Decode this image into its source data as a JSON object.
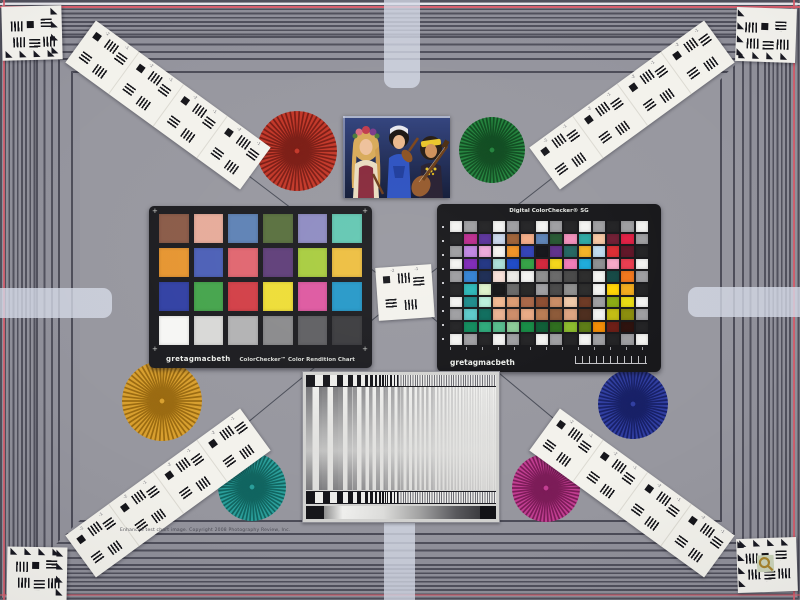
{
  "scene": {
    "type": "camera test chart scene photograph",
    "background_color": "#97979f",
    "frame_stripe_dark": "#50505c",
    "frame_stripe_light": "#8f8f99",
    "registration_line_color": "#d95f6e",
    "edge_tab_color": "#d6dbe8",
    "string_color": "#3c404b"
  },
  "glyphs": {
    "triangle": "◣",
    "plus": "+"
  },
  "fine_print": "Enhanced test chart image. Copyright 2008 Photography Review, Inc.",
  "resolution_marks": [
    "-2",
    "-1"
  ],
  "colorchecker_classic": {
    "brand": "gretagmacbeth",
    "title": "ColorChecker™ Color Rendition Chart",
    "patch_rows": [
      [
        "#8a5a47",
        "#e6ab99",
        "#5d81b5",
        "#586f3d",
        "#8e8bc2",
        "#62c7b2"
      ],
      [
        "#e69530",
        "#4b5fb6",
        "#e0656f",
        "#5e3d78",
        "#a8cc3e",
        "#edbe3f"
      ],
      [
        "#3140a3",
        "#44a44b",
        "#d23e46",
        "#eedd35",
        "#de58a0",
        "#2598c8"
      ],
      [
        "#f6f6f4",
        "#d8d8d6",
        "#b2b2b3",
        "#8a8a8c",
        "#5f5f62",
        "#3b3b3e"
      ]
    ]
  },
  "colorchecker_sg": {
    "title": "Digital ColorChecker® SG",
    "brand": "gretagmacbeth",
    "patch_rows": [
      [
        "#f3f3f1",
        "#9d9da0",
        "#202022",
        "#f3f3f1",
        "#9d9da0",
        "#202022",
        "#f3f3f1",
        "#9d9da0",
        "#202022",
        "#f3f3f1",
        "#9d9da0",
        "#202022",
        "#9d9da0",
        "#f3f3f1"
      ],
      [
        "#202022",
        "#bb2a8e",
        "#58309a",
        "#c9d6ea",
        "#9d5f34",
        "#f3ab85",
        "#5b81b5",
        "#23552f",
        "#f08fba",
        "#2ba8a2",
        "#f6c6a2",
        "#6e1b31",
        "#e01d42",
        "#9d9da0"
      ],
      [
        "#9d9da0",
        "#bf84e2",
        "#eda8da",
        "#f6f4ef",
        "#f09122",
        "#2e3eb4",
        "#101015",
        "#5c2d88",
        "#20635e",
        "#f2b222",
        "#bedbef",
        "#da2a30",
        "#5e1224",
        "#202022"
      ],
      [
        "#f3f3f1",
        "#7c25b6",
        "#1d3180",
        "#aaded6",
        "#1945c6",
        "#30a041",
        "#d22238",
        "#f4d515",
        "#f27ab6",
        "#1aaada",
        "#8c8e90",
        "#f6a8c6",
        "#ea3a4d",
        "#f3f3f1"
      ],
      [
        "#9d9da0",
        "#3080d2",
        "#182850",
        "#f8e0d8",
        "#eceae6",
        "#f3f3f1",
        "#8c8c8c",
        "#666666",
        "#464646",
        "#282828",
        "#f3f3f1",
        "#114642",
        "#f27519",
        "#9d9da0"
      ],
      [
        "#202022",
        "#2ab6b6",
        "#def2ca",
        "#111113",
        "#666666",
        "#222222",
        "#9d9da0",
        "#464646",
        "#8c8c8c",
        "#282828",
        "#f3f3f1",
        "#ffd400",
        "#f2aa1a",
        "#202022"
      ],
      [
        "#f3f3f1",
        "#1a8a8a",
        "#baf0dc",
        "#f2b890",
        "#dc9a70",
        "#a86444",
        "#8a4a2e",
        "#c88a62",
        "#f0c8a8",
        "#6a3620",
        "#9d9da0",
        "#8aaa10",
        "#eadc10",
        "#f3f3f1"
      ],
      [
        "#9d9da0",
        "#5ac8c8",
        "#0a6a5a",
        "#eab090",
        "#cc8a66",
        "#e8a882",
        "#b87a50",
        "#8a5634",
        "#dca27e",
        "#4a2a1a",
        "#f3f3f1",
        "#c2bc10",
        "#8a8c0a",
        "#9d9da0"
      ],
      [
        "#202022",
        "#0e8a5a",
        "#2aa878",
        "#54ba8a",
        "#8aca96",
        "#128a42",
        "#0a5a32",
        "#2a6a1a",
        "#8aba2a",
        "#5a7a12",
        "#f28a00",
        "#6a1a12",
        "#2a0e0a",
        "#202022"
      ],
      [
        "#f3f3f1",
        "#9d9da0",
        "#202022",
        "#f3f3f1",
        "#9d9da0",
        "#202022",
        "#f3f3f1",
        "#9d9da0",
        "#202022",
        "#f3f3f1",
        "#9d9da0",
        "#202022",
        "#9d9da0",
        "#f3f3f1"
      ]
    ]
  },
  "starbursts": [
    {
      "name": "red",
      "color": "#c23526",
      "dark": "#7a1a12",
      "x": 297,
      "y": 151,
      "r": 40
    },
    {
      "name": "green",
      "color": "#20803a",
      "dark": "#0d4a1e",
      "x": 492,
      "y": 150,
      "r": 33
    },
    {
      "name": "amber",
      "color": "#d89f2e",
      "dark": "#9a6a10",
      "x": 162,
      "y": 401,
      "r": 40
    },
    {
      "name": "teal",
      "color": "#2a9e9a",
      "dark": "#116560",
      "x": 252,
      "y": 487,
      "r": 34
    },
    {
      "name": "navy",
      "color": "#2f3da0",
      "dark": "#161f66",
      "x": 633,
      "y": 404,
      "r": 35
    },
    {
      "name": "magenta",
      "color": "#c23e92",
      "dark": "#7c1c58",
      "x": 546,
      "y": 488,
      "r": 34
    }
  ],
  "photo": {
    "subject": "three musicians in folk costume",
    "background": "#1c2a56",
    "palette": [
      "#eec09a",
      "#2b50c0",
      "#e8c428",
      "#87283a",
      "#8a5524"
    ]
  },
  "sweep_chart": {
    "type": "log frequency sweep",
    "block_count": 38,
    "block_start_width": 9,
    "block_decay": 0.9,
    "slice_widths": [
      6.5,
      5.5,
      4.8,
      4.2,
      3.6,
      3.1,
      2.7,
      2.3,
      1.9,
      1.6,
      1.35,
      1.15
    ],
    "slice_alphas": [
      0.55,
      0.52,
      0.48,
      0.44,
      0.4,
      0.35,
      0.3,
      0.25,
      0.2,
      0.16,
      0.12,
      0.09
    ]
  }
}
